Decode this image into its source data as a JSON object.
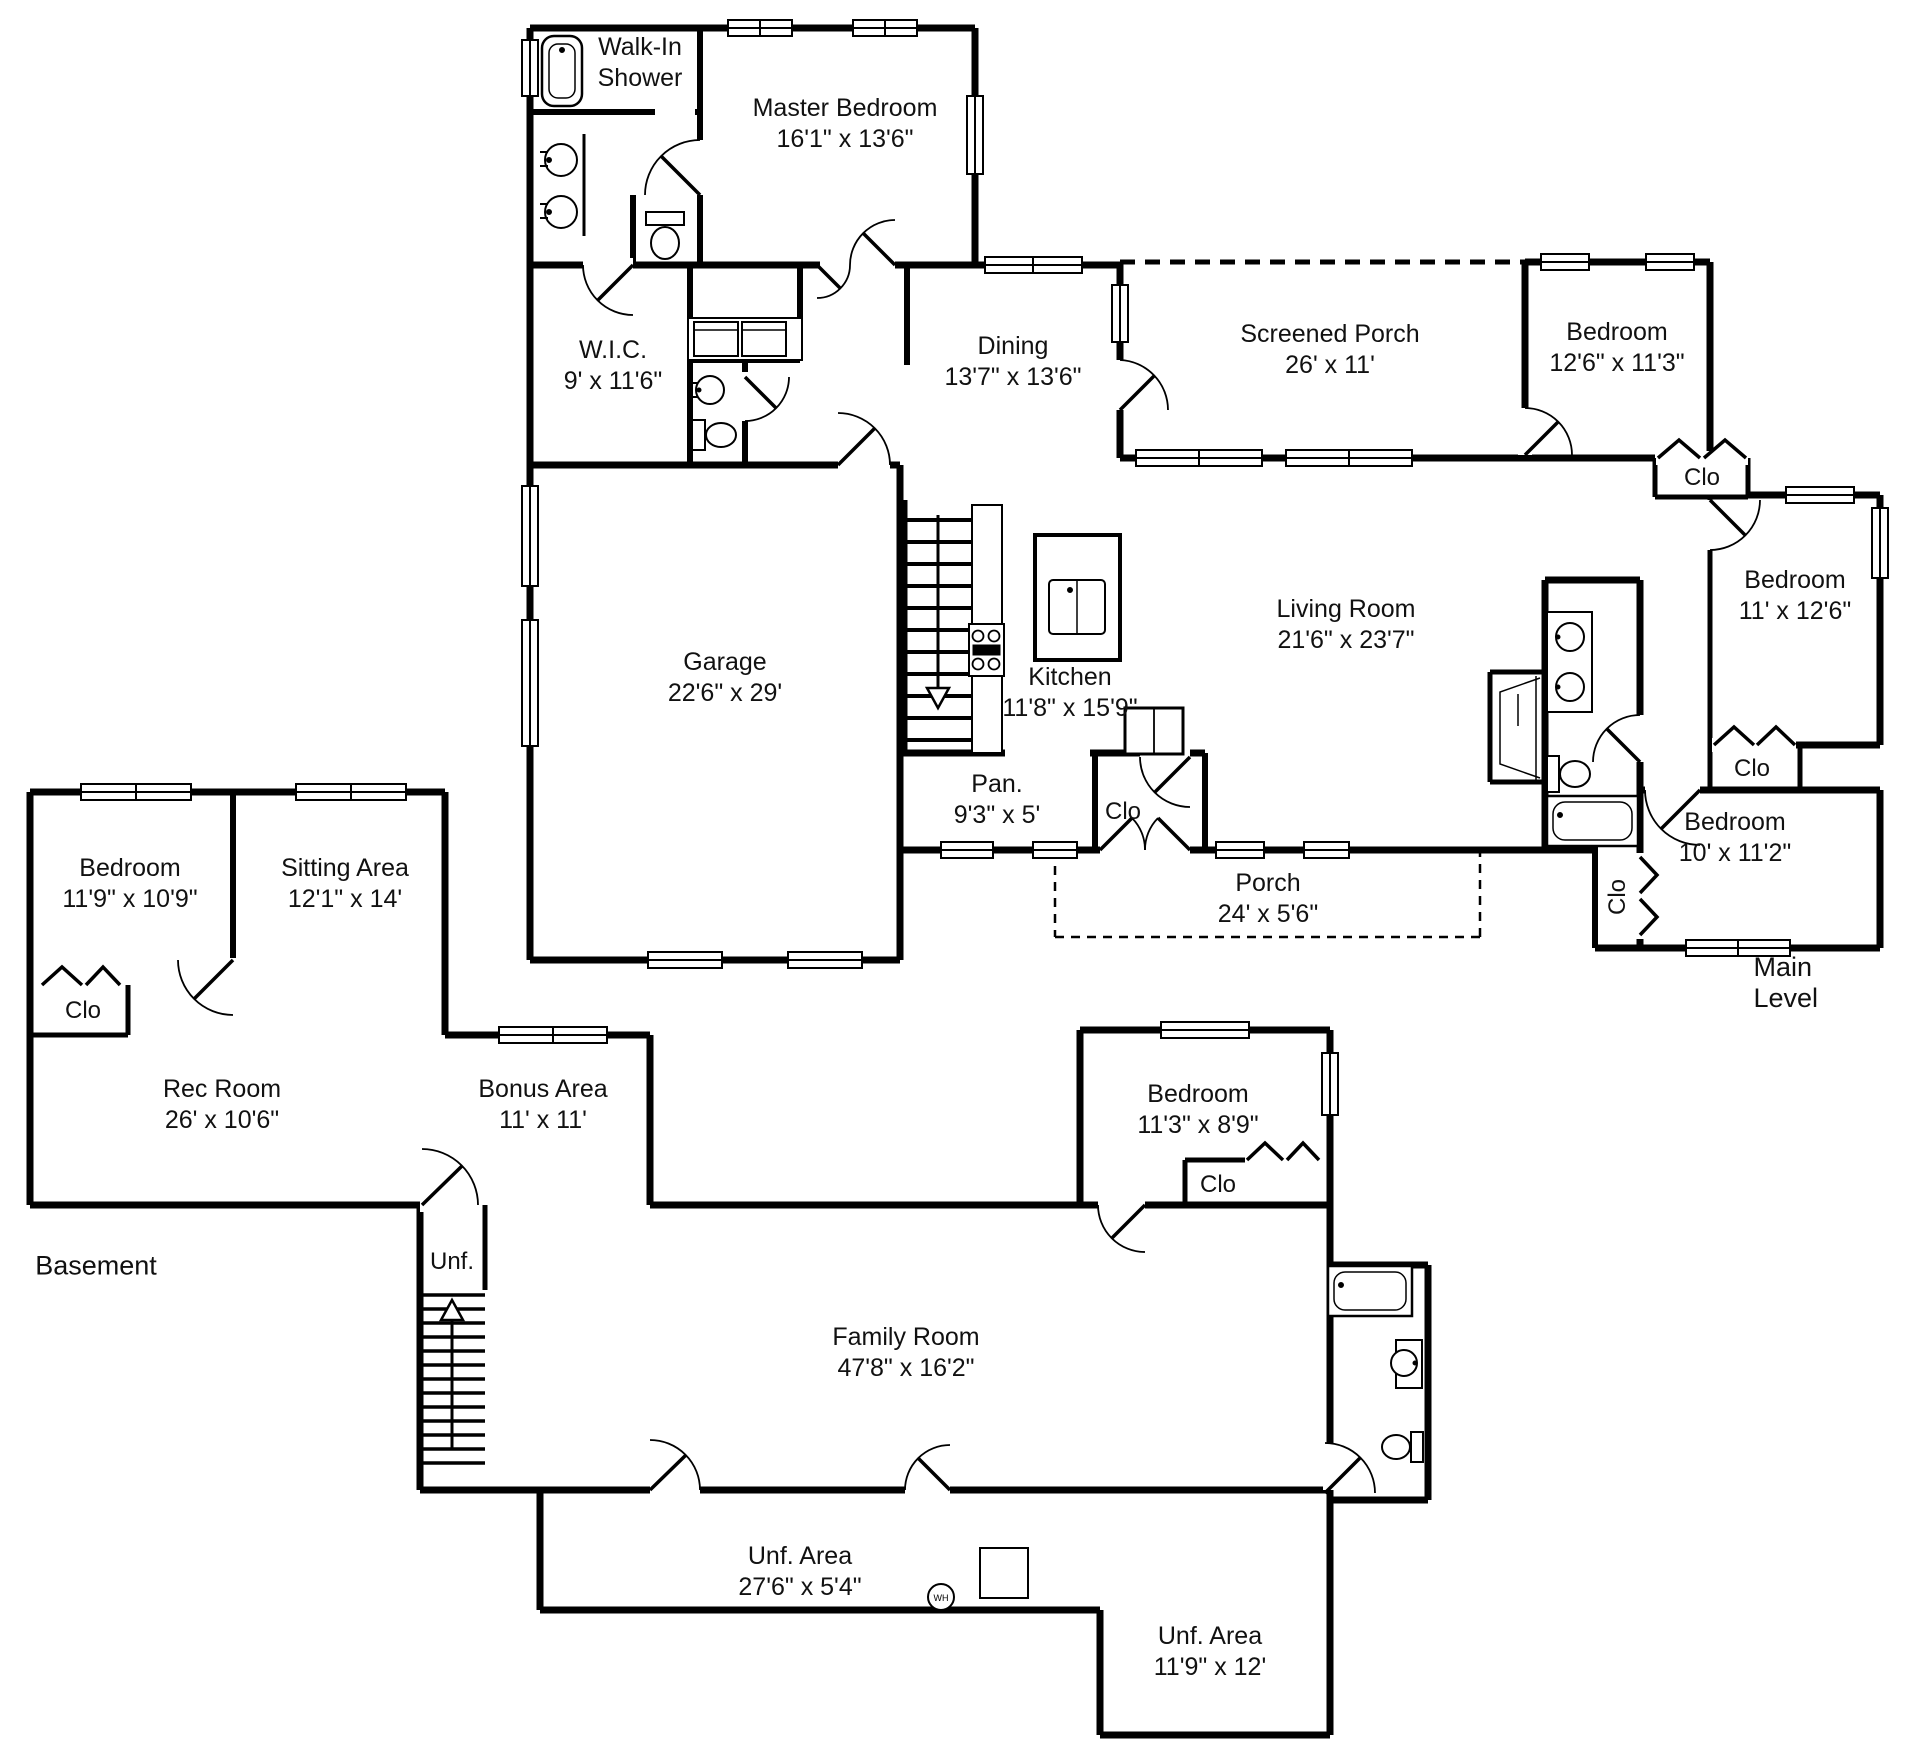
{
  "floorplan": {
    "main": {
      "level_label": "Main Level",
      "rooms": {
        "walk_in_shower": {
          "name": "Walk-In Shower",
          "dims": ""
        },
        "master_bedroom": {
          "name": "Master Bedroom",
          "dims": "16'1\" x 13'6\""
        },
        "wic": {
          "name": "W.I.C.",
          "dims": "9' x 11'6\""
        },
        "dining": {
          "name": "Dining",
          "dims": "13'7\" x 13'6\""
        },
        "screened_porch": {
          "name": "Screened Porch",
          "dims": "26' x 11'"
        },
        "bedroom_ne": {
          "name": "Bedroom",
          "dims": "12'6\" x 11'3\""
        },
        "bedroom_e": {
          "name": "Bedroom",
          "dims": "11' x 12'6\""
        },
        "living_room": {
          "name": "Living Room",
          "dims": "21'6\" x 23'7\""
        },
        "kitchen": {
          "name": "Kitchen",
          "dims": "11'8\" x 15'9\""
        },
        "garage": {
          "name": "Garage",
          "dims": "22'6\" x 29'"
        },
        "pantry": {
          "name": "Pan.",
          "dims": "9'3\" x 5'"
        },
        "porch": {
          "name": "Porch",
          "dims": "24' x 5'6\""
        },
        "bedroom_se": {
          "name": "Bedroom",
          "dims": "10' x 11'2\""
        }
      },
      "closets": {
        "kitchen_closet": "Clo",
        "ne_closet": "Clo",
        "e_closet": "Clo",
        "bath_closet": "Clo"
      }
    },
    "basement": {
      "level_label": "Basement",
      "rooms": {
        "bedroom_nw": {
          "name": "Bedroom",
          "dims": "11'9\" x 10'9\""
        },
        "sitting_area": {
          "name": "Sitting Area",
          "dims": "12'1\" x 14'"
        },
        "rec_room": {
          "name": "Rec Room",
          "dims": "26' x 10'6\""
        },
        "bonus_area": {
          "name": "Bonus Area",
          "dims": "11' x 11'"
        },
        "unf_stairs": {
          "name": "Unf.",
          "dims": ""
        },
        "family_room": {
          "name": "Family Room",
          "dims": "47'8\" x 16'2\""
        },
        "bedroom_e": {
          "name": "Bedroom",
          "dims": "11'3\" x 8'9\""
        },
        "unf_strip": {
          "name": "Unf. Area",
          "dims": "27'6\" x 5'4\""
        },
        "unf_se": {
          "name": "Unf. Area",
          "dims": "11'9\" x 12'"
        }
      },
      "closets": {
        "nw_closet": "Clo",
        "e_closet": "Clo"
      },
      "water_heater": "WH"
    }
  }
}
